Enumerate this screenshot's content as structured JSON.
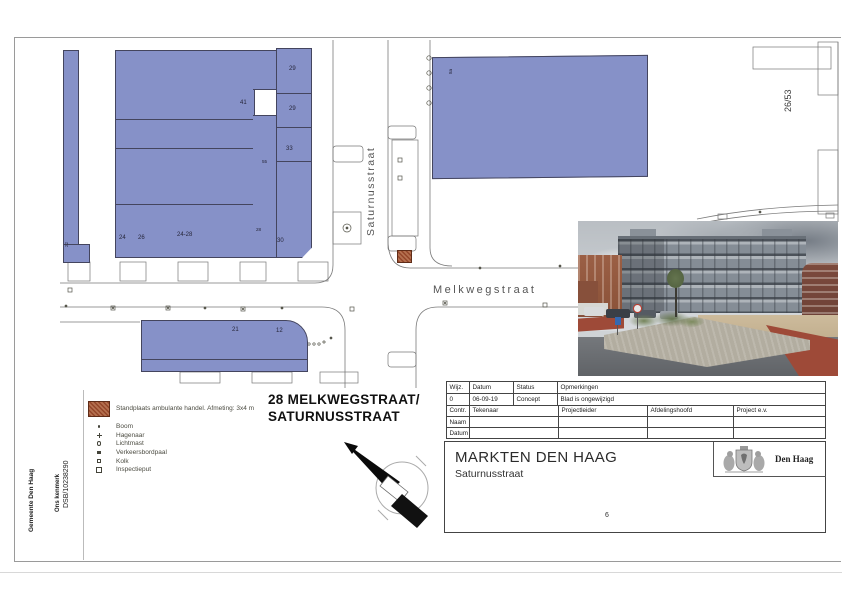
{
  "margin": {
    "gemeente": "Gemeente Den Haag",
    "kenmerk_label": "Ons kenmerk",
    "kenmerk_value": "DSB/10238290"
  },
  "map": {
    "streets": {
      "saturnus": "Saturnusstraat",
      "melkweg": "Melkwegstraat"
    },
    "plot_ref": "26/53",
    "labels": {
      "l29a": "29",
      "l41": "41",
      "l29b": "29",
      "l33": "33",
      "l55": "55",
      "l24": "24",
      "l26": "26",
      "l2428": "24-28",
      "l28": "28",
      "l30": "30",
      "l22": "22",
      "l8a": "8a",
      "l21": "21",
      "l12": "12"
    }
  },
  "legend": {
    "standplaats_label": "Standplaats ambulante handel. Afmeting: 3x4 m",
    "items": [
      {
        "symbol": "boom-icon",
        "label": "Boom"
      },
      {
        "symbol": "hagenaar-icon",
        "label": "Hagenaar"
      },
      {
        "symbol": "lichtmast-icon",
        "label": "Lichtmast"
      },
      {
        "symbol": "verkeersbordpaal-icon",
        "label": "Verkeersbordpaal"
      },
      {
        "symbol": "kolk-icon",
        "label": "Kolk"
      },
      {
        "symbol": "inspectieput-icon",
        "label": "Inspectieput"
      }
    ]
  },
  "doc_title": {
    "line1": "28 MELKWEGSTRAAT/",
    "line2": "SATURNUSSTRAAT"
  },
  "revision_table": {
    "headers": [
      "Wijz.",
      "Datum",
      "Status",
      "Opmerkingen"
    ],
    "row": [
      "0",
      "06-09-19",
      "Concept",
      "Blad is ongewijzigd"
    ],
    "roles": [
      "Contr.",
      "Tekenaar",
      "Projectleider",
      "Afdelingshoofd",
      "Project e.v."
    ],
    "naam_label": "Naam",
    "datum_label": "Datum"
  },
  "title_block": {
    "org": "MARKTEN DEN HAAG",
    "subtitle": "Saturnusstraat",
    "brand": "Den Haag",
    "page_number": "6"
  },
  "colors": {
    "building": "#8691c8",
    "standplaats": "#94462a",
    "linework": "#7a7a7a"
  }
}
